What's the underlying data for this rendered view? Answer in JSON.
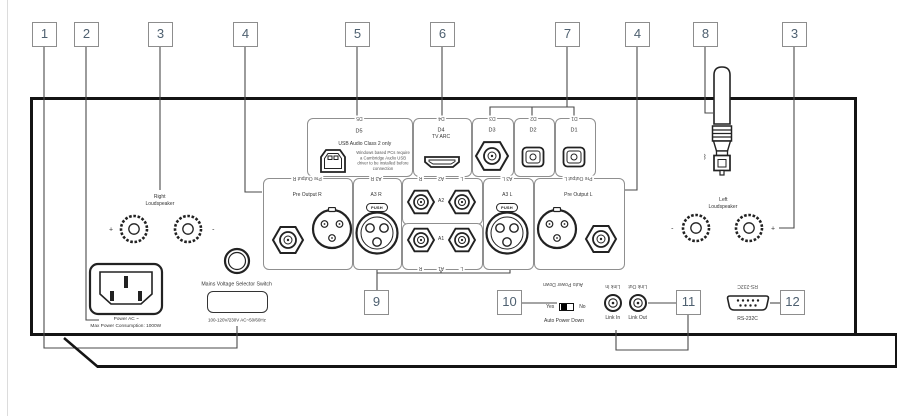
{
  "callouts": {
    "top": [
      "1",
      "2",
      "3",
      "4",
      "5",
      "6",
      "7",
      "4",
      "8",
      "3"
    ],
    "bottom": [
      "9",
      "10",
      "11",
      "12"
    ]
  },
  "digital_inputs": {
    "d5": {
      "name": "D5",
      "type": "USB Audio Class 2 only",
      "note": "Windows based PCs require a Cambridge Audio USB driver to be installed before connection"
    },
    "d4": {
      "name": "D4",
      "sub": "TV ARC"
    },
    "d3": {
      "name": "D3"
    },
    "d2": {
      "name": "D2"
    },
    "d1": {
      "name": "D1"
    }
  },
  "analog_io": {
    "pre_output_r": {
      "name": "Pre Output R"
    },
    "a3_r": {
      "name": "A3 R",
      "push": "PUSH"
    },
    "a2": {
      "name": "A2",
      "left": "R",
      "right": "L"
    },
    "a1": {
      "name": "A1",
      "left": "R",
      "right": "L"
    },
    "a3_l": {
      "name": "A3 L",
      "push": "PUSH"
    },
    "pre_output_l": {
      "name": "Pre Output L"
    }
  },
  "speakers": {
    "right": {
      "line1": "Right",
      "line2": "Loudspeaker",
      "plus": "+",
      "minus": "-"
    },
    "left": {
      "line1": "Left",
      "line2": "Loudspeaker",
      "plus": "+",
      "minus": "-"
    }
  },
  "power": {
    "ac": "Power AC ~",
    "max": "Max Power Consumption: 1000W",
    "selector": "Mains Voltage Selector Switch",
    "voltage": "100-120V/230V AC~50/60Hz"
  },
  "controls": {
    "auto_power_down": {
      "label": "Auto Power Down",
      "yes": "Yes",
      "no": "No"
    },
    "link_in": {
      "label": "Link In"
    },
    "link_out": {
      "label": "Link Out"
    },
    "rs232": {
      "label": "RS-232C"
    }
  },
  "icons": {
    "bluetooth": "ᛒ"
  }
}
